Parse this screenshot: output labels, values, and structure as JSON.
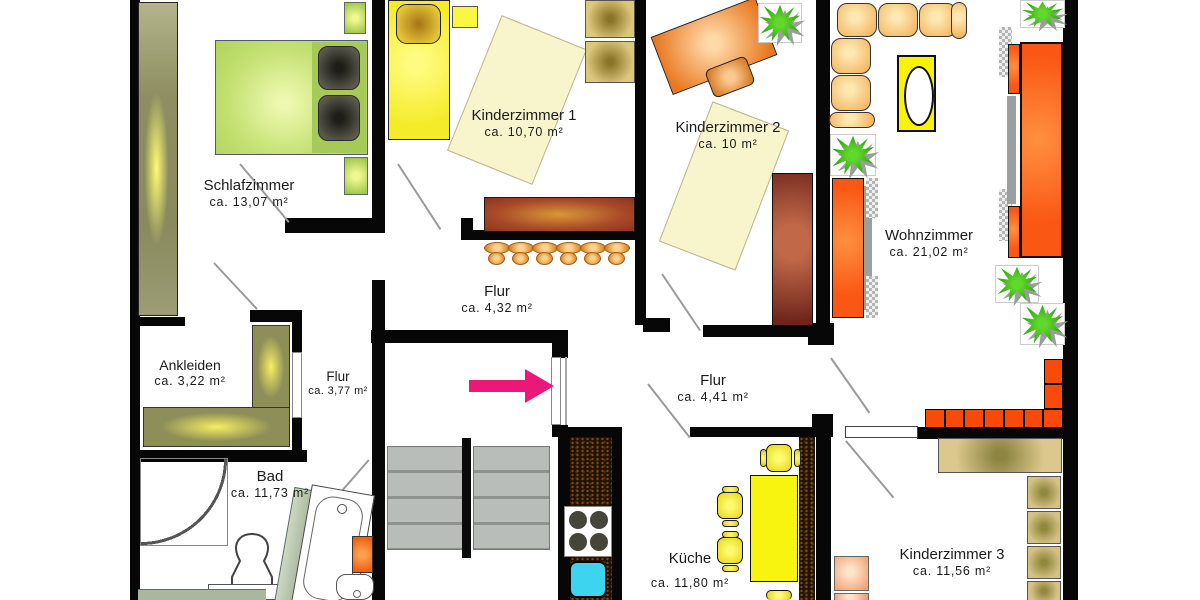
{
  "title": "Wohnung Grundriss (floor plan)",
  "rooms": [
    {
      "name": "Schlafzimmer",
      "area": "ca. 13,07 m²"
    },
    {
      "name": "Kinderzimmer 1",
      "area": "ca. 10,70 m²"
    },
    {
      "name": "Kinderzimmer 2",
      "area": "ca. 10 m²"
    },
    {
      "name": "Wohnzimmer",
      "area": "ca. 21,02 m²"
    },
    {
      "name": "Ankleiden",
      "area": "ca. 3,22 m²"
    },
    {
      "name": "Flur",
      "area": "ca. 3,77 m²"
    },
    {
      "name": "Flur",
      "area": "ca. 4,32 m²"
    },
    {
      "name": "Flur",
      "area": "ca. 4,41 m²"
    },
    {
      "name": "Bad",
      "area": "ca. 11,73 m²"
    },
    {
      "name": "Küche",
      "area": "ca. 11,80 m²"
    },
    {
      "name": "Kinderzimmer 3",
      "area": "ca. 11,56 m²"
    }
  ],
  "counts": {
    "plants": 5,
    "bar_stools": 6,
    "stair_rows": 4
  },
  "palette": {
    "wall": "#070707",
    "entrance_arrow": "#ea1878",
    "bed_green": "#c2e070",
    "bed_yellow": "#f4ec28",
    "wardrobe_olive": "#8e8e5e",
    "sideboard_red": "#a84828",
    "sofa_cushion": "#f3b45d",
    "living_orange": "#fa5714",
    "brick_orange": "#fa4a0a",
    "kitchen_counter": "#221204",
    "sink_cyan": "#3cd4ee",
    "stairs_gray": "#b9bdb9",
    "bath_green": "#a9b79f",
    "plant_green": "#1d9e08"
  }
}
